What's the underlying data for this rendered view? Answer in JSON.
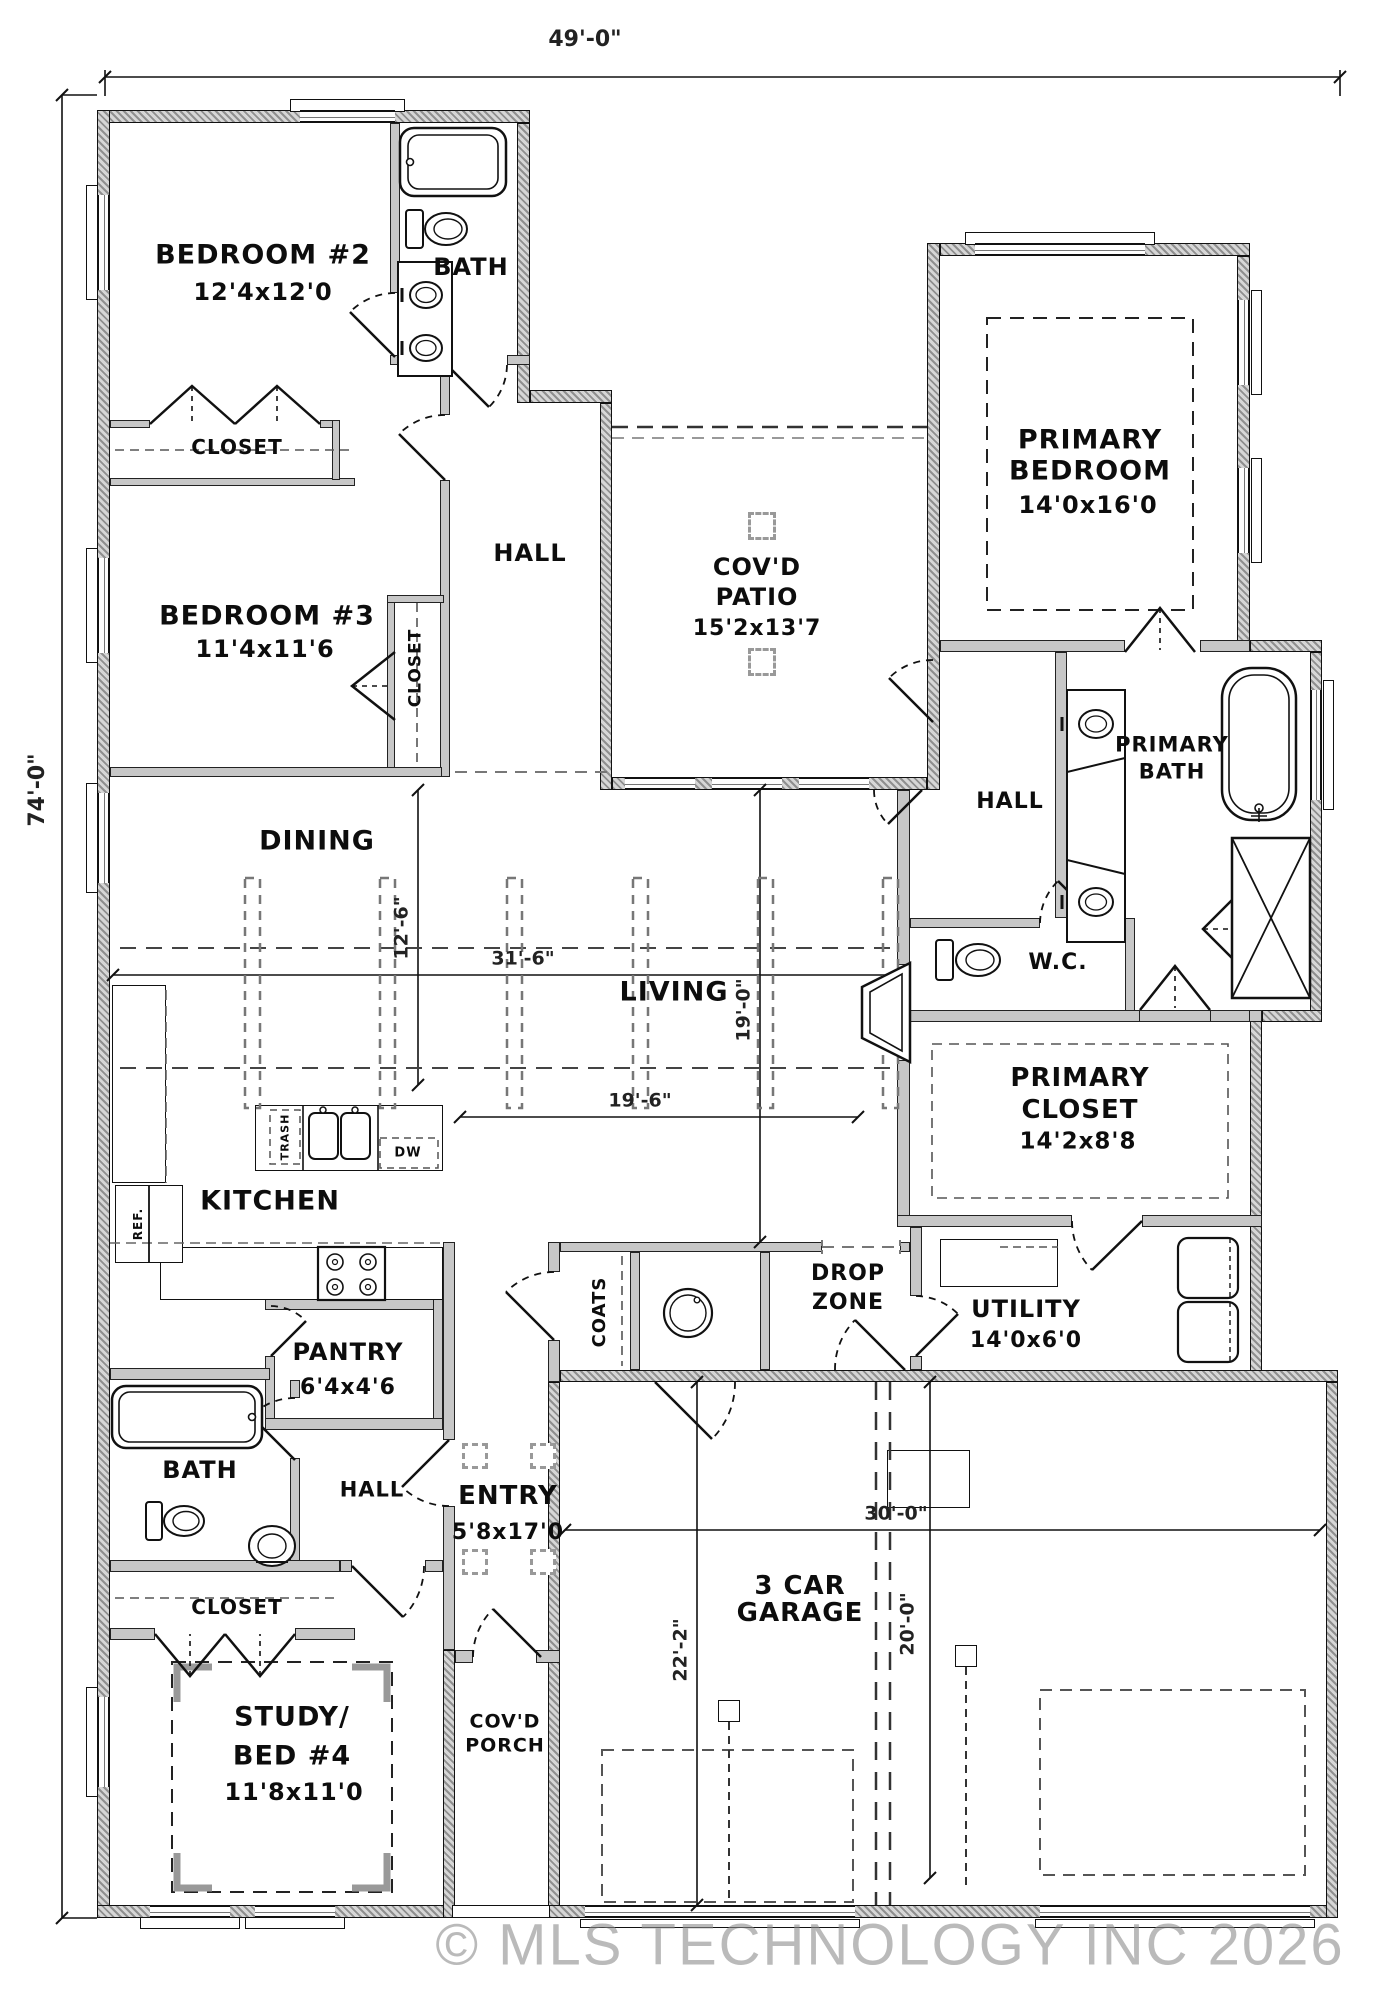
{
  "watermark": "© MLS TECHNOLOGY INC 2026",
  "dimensions": {
    "overall_width": "49'-0\"",
    "overall_depth": "74'-0\"",
    "living_width": "31'-6\"",
    "dining_depth": "12'-6\"",
    "living_depth": "19'-0\"",
    "living_inner_width": "19'-6\"",
    "garage_width": "30'-0\"",
    "garage_bay_depth": "22'-2\"",
    "garage_bay2_depth": "20'-0\""
  },
  "rooms": {
    "bedroom2": {
      "name": "BEDROOM #2",
      "size": "12'4x12'0"
    },
    "bath_upper": {
      "name": "BATH"
    },
    "closet_bedroom2": {
      "name": "CLOSET"
    },
    "bedroom3": {
      "name": "BEDROOM #3",
      "size": "11'4x11'6"
    },
    "closet_bedroom3": {
      "name": "CLOSET"
    },
    "hall_upper": {
      "name": "HALL"
    },
    "covd_patio": {
      "line1": "COV'D",
      "line2": "PATIO",
      "size": "15'2x13'7"
    },
    "primary_bedroom": {
      "line1": "PRIMARY",
      "line2": "BEDROOM",
      "size": "14'0x16'0"
    },
    "primary_bath": {
      "line1": "PRIMARY",
      "line2": "BATH"
    },
    "hall_primary": {
      "name": "HALL"
    },
    "wc": {
      "name": "W.C."
    },
    "primary_closet": {
      "line1": "PRIMARY",
      "line2": "CLOSET",
      "size": "14'2x8'8"
    },
    "dining": {
      "name": "DINING"
    },
    "living": {
      "name": "LIVING"
    },
    "kitchen": {
      "name": "KITCHEN"
    },
    "pantry": {
      "name": "PANTRY",
      "size": "6'4x4'6"
    },
    "coats": {
      "name": "COATS"
    },
    "drop_zone": {
      "line1": "DROP",
      "line2": "ZONE"
    },
    "utility": {
      "name": "UTILITY",
      "size": "14'0x6'0"
    },
    "bath_lower": {
      "name": "BATH"
    },
    "hall_lower": {
      "name": "HALL"
    },
    "entry": {
      "name": "ENTRY",
      "size": "5'8x17'0"
    },
    "closet_lower": {
      "name": "CLOSET"
    },
    "study": {
      "line1": "STUDY/",
      "line2": "BED #4",
      "size": "11'8x11'0"
    },
    "covd_porch": {
      "line1": "COV'D",
      "line2": "PORCH"
    },
    "garage": {
      "line1": "3 CAR",
      "line2": "GARAGE"
    }
  },
  "appliances": {
    "refrigerator": "REF.",
    "trash": "TRASH",
    "dishwasher": "DW"
  }
}
